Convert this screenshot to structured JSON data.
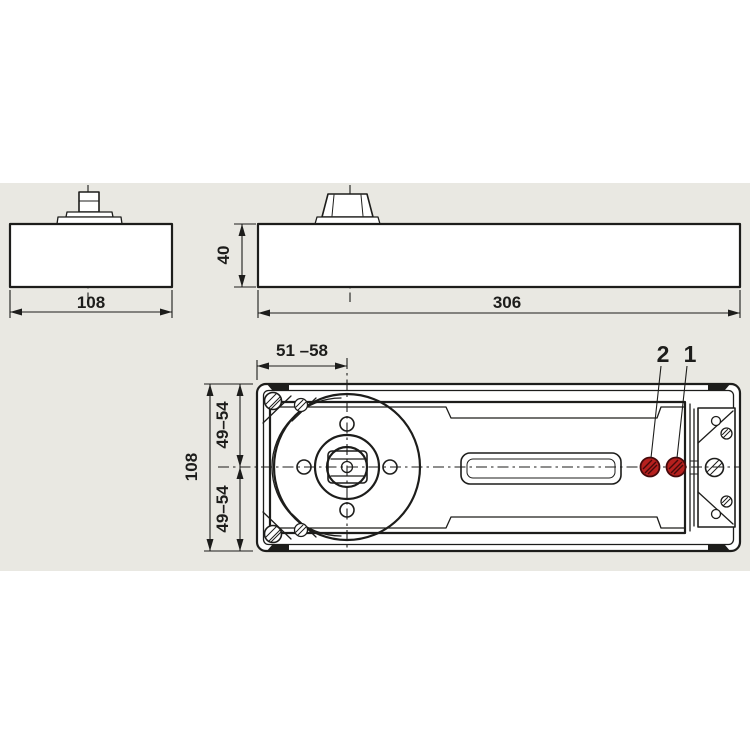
{
  "colors": {
    "canvas": "#ffffff",
    "panel_gray": "#e9e8e2",
    "line": "#1d1d1b",
    "valve_red": "#b6201e"
  },
  "side_view_small": {
    "width": "108"
  },
  "side_view_long": {
    "height": "40",
    "length": "306"
  },
  "plan_view": {
    "spindle_offset": "51 –58",
    "overall_height": "108",
    "upper_half": "49–54",
    "lower_half": "49–54",
    "callout_2": "2",
    "callout_1": "1"
  }
}
